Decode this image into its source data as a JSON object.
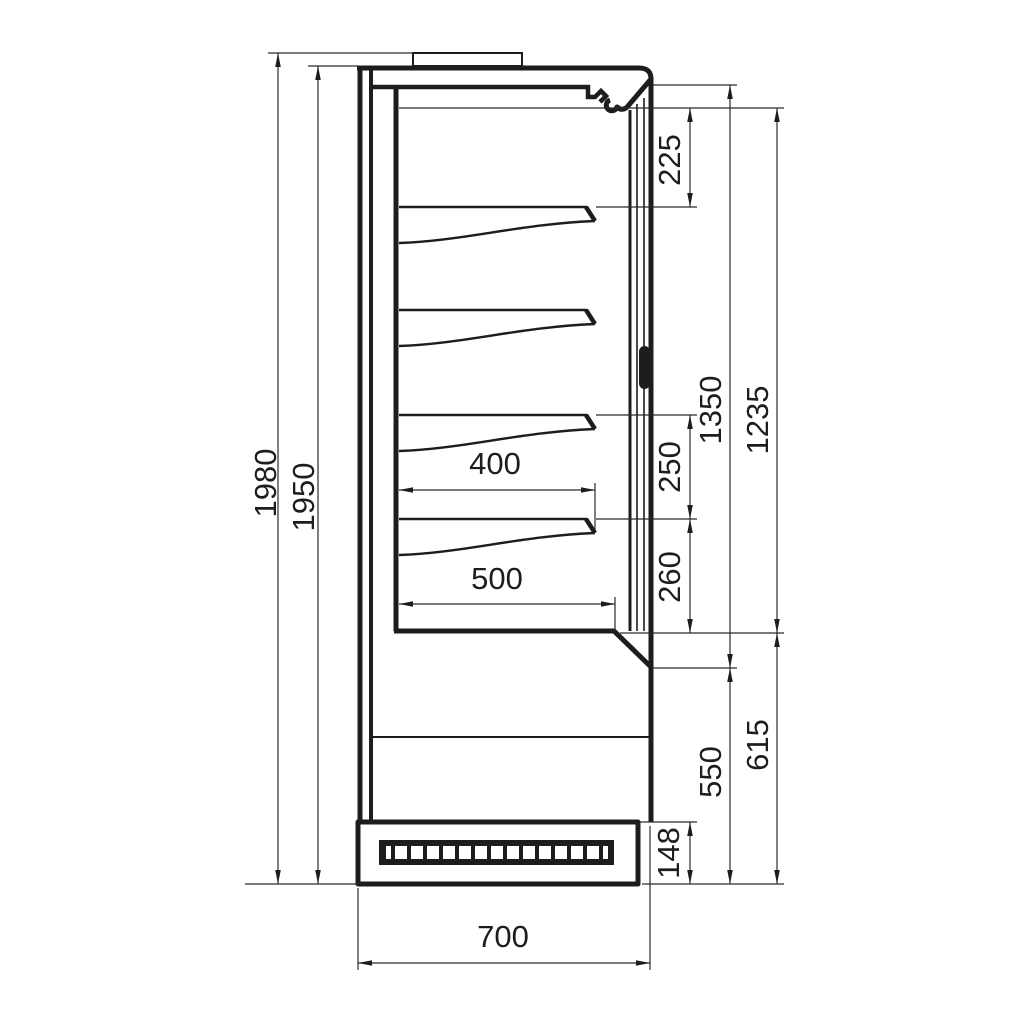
{
  "dimensions": {
    "overall_height": "1980",
    "body_height": "1950",
    "top_to_first_shelf": "225",
    "shelf_spacing_upper": "250",
    "shelf_spacing_lower": "260",
    "opening_height": "1350",
    "display_height": "1235",
    "lower_front_height": "550",
    "bottom_section_height": "615",
    "plinth_height": "148",
    "shelf_depth": "400",
    "well_depth": "500",
    "base_depth": "700"
  }
}
